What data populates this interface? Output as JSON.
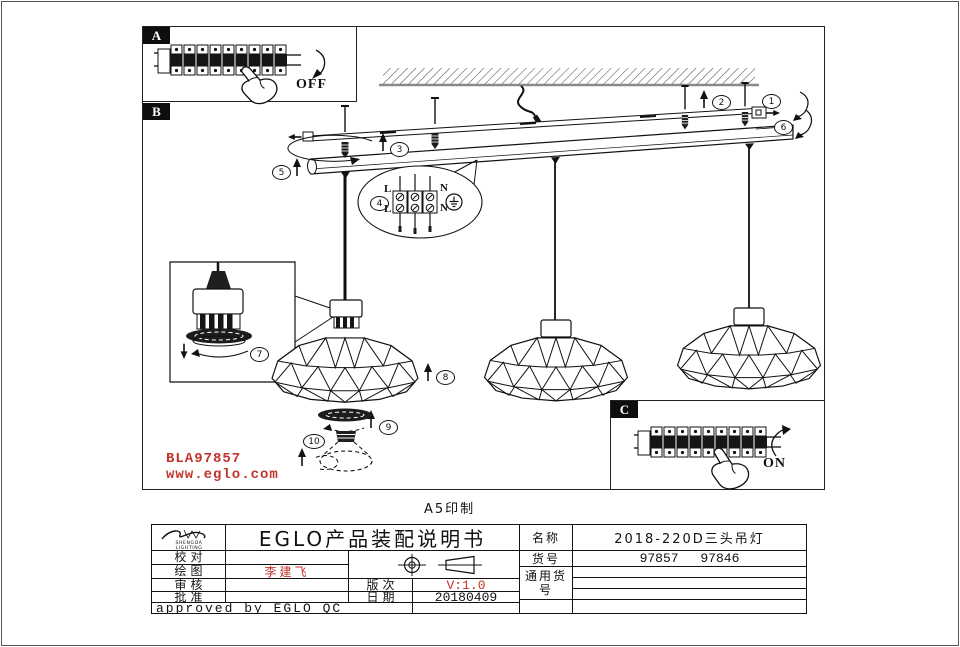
{
  "page": {
    "print_note": "A5印制"
  },
  "diagram": {
    "section_a": "A",
    "section_b": "B",
    "section_c": "C",
    "off_label": "OFF",
    "on_label": "ON",
    "callouts": {
      "c1": "1",
      "c2": "2",
      "c3": "3",
      "c4": "4",
      "c5": "5",
      "c6": "6",
      "c7": "7",
      "c8": "8",
      "c9": "9",
      "c10": "10"
    },
    "terminal": {
      "l_top": "L",
      "l_bottom": "L",
      "n_top": "N",
      "n_bottom": "N"
    },
    "watermark_code": "BLA97857",
    "watermark_url": "www.eglo.com"
  },
  "title_block": {
    "logo_line1": "SHENGDA",
    "logo_line2": "LIGHTING",
    "doc_title": "EGLO产品装配说明书",
    "proofread_label": "校对",
    "drawing_label": "绘图",
    "drawing_value": "李建飞",
    "review_label": "审核",
    "approval_label": "批准",
    "version_label": "版次",
    "version_value": "V:1.0",
    "date_label": "日期",
    "date_value": "20180409",
    "approved_note": "approved by EGLO QC",
    "name_label": "名称",
    "name_value": "2018-220D三头吊灯",
    "item_label": "货号",
    "item_value": "97857 97846",
    "common_label": "通用货号"
  },
  "colors": {
    "accent_red": "#c0352c",
    "line": "#111111"
  }
}
